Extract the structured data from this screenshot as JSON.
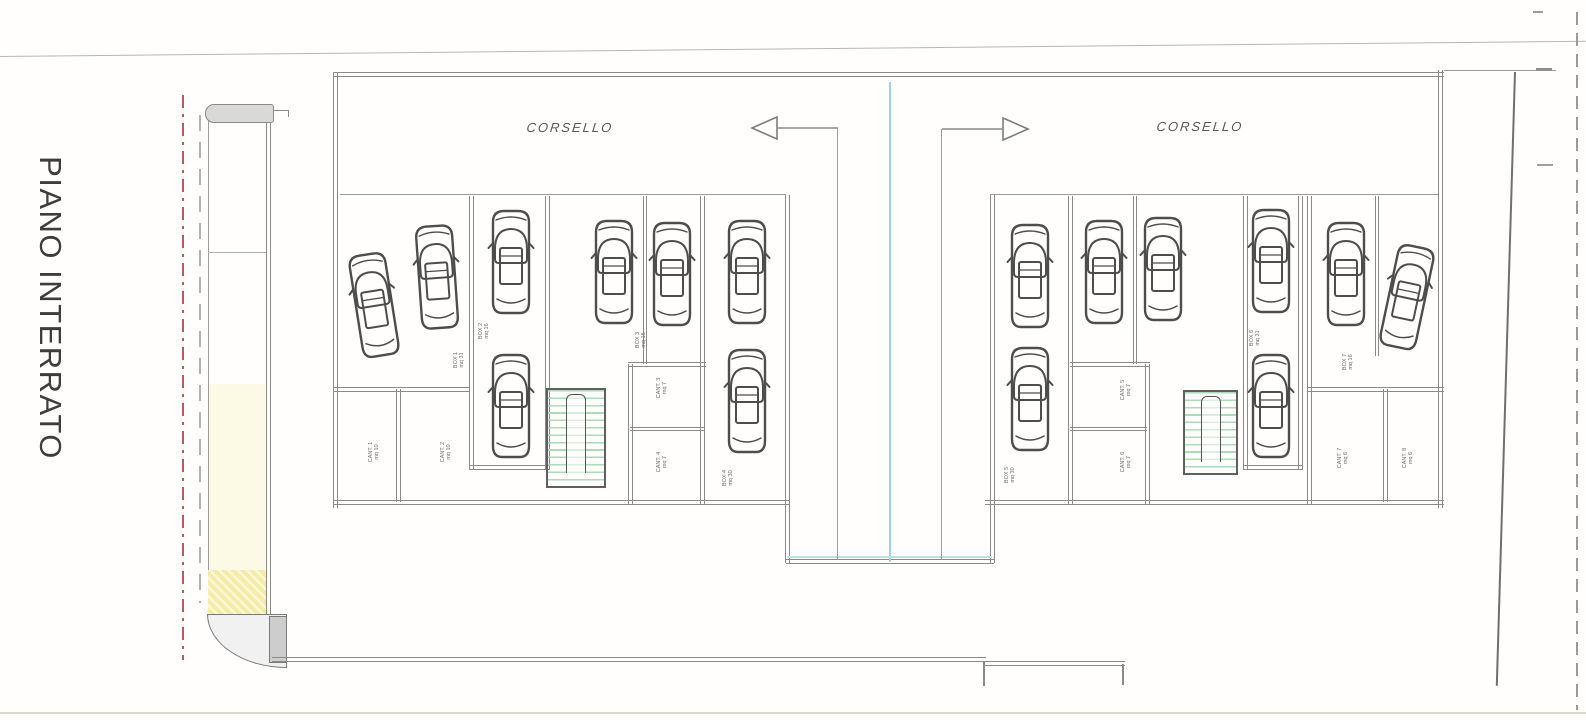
{
  "title": {
    "text": "PIANO INTERRATO"
  },
  "aisle_labels": {
    "left": "CORSELLO",
    "right": "CORSELLO"
  },
  "colors": {
    "wall_gray": "#8a8a8a",
    "thin_line": "#9b9b9b",
    "centerline_cyan": "#9ad6d8",
    "boundary_red": "#b85a5a",
    "stair_green": "#aedab6",
    "ramp_yellow": "#f4eba6",
    "text_dark": "#3d3d3d"
  },
  "plan": {
    "car_count": 16,
    "cars": [
      {
        "id": "car-1",
        "x": 374,
        "y": 305,
        "rot": -9
      },
      {
        "id": "car-2",
        "x": 437,
        "y": 277,
        "rot": -4
      },
      {
        "id": "car-3",
        "x": 511,
        "y": 262,
        "rot": 0
      },
      {
        "id": "car-4",
        "x": 511,
        "y": 406,
        "rot": 0
      },
      {
        "id": "car-5",
        "x": 614,
        "y": 272,
        "rot": 0
      },
      {
        "id": "car-6",
        "x": 672,
        "y": 274,
        "rot": 0
      },
      {
        "id": "car-7",
        "x": 747,
        "y": 272,
        "rot": 0
      },
      {
        "id": "car-8",
        "x": 747,
        "y": 401,
        "rot": 0
      },
      {
        "id": "car-9",
        "x": 1030,
        "y": 276,
        "rot": 0
      },
      {
        "id": "car-10",
        "x": 1030,
        "y": 399,
        "rot": 0
      },
      {
        "id": "car-11",
        "x": 1104,
        "y": 272,
        "rot": 0
      },
      {
        "id": "car-12",
        "x": 1163,
        "y": 269,
        "rot": 0
      },
      {
        "id": "car-13",
        "x": 1271,
        "y": 261,
        "rot": 0
      },
      {
        "id": "car-14",
        "x": 1271,
        "y": 406,
        "rot": 0
      },
      {
        "id": "car-15",
        "x": 1346,
        "y": 274,
        "rot": 0
      },
      {
        "id": "car-16",
        "x": 1407,
        "y": 297,
        "rot": 12
      }
    ],
    "room_labels": [
      {
        "x": 374,
        "y": 452,
        "text": "CANT. 1\nmq 10"
      },
      {
        "x": 446,
        "y": 452,
        "text": "CANT. 2\nmq 10"
      },
      {
        "x": 459,
        "y": 360,
        "text": "BOX 1\nmq 31"
      },
      {
        "x": 484,
        "y": 331,
        "text": "BOX 2\nmq 16"
      },
      {
        "x": 641,
        "y": 340,
        "text": "BOX 3\nmq 16"
      },
      {
        "x": 662,
        "y": 388,
        "text": "CANT. 3\nmq 7"
      },
      {
        "x": 662,
        "y": 462,
        "text": "CANT. 4\nmq 7"
      },
      {
        "x": 728,
        "y": 478,
        "text": "BOX 4\nmq 30"
      },
      {
        "x": 1010,
        "y": 475,
        "text": "BOX 5\nmq 30"
      },
      {
        "x": 1126,
        "y": 390,
        "text": "CANT. 5\nmq 7"
      },
      {
        "x": 1126,
        "y": 462,
        "text": "CANT. 6\nmq 7"
      },
      {
        "x": 1255,
        "y": 338,
        "text": "BOX 6\nmq 31"
      },
      {
        "x": 1348,
        "y": 362,
        "text": "BOX 7\nmq 16"
      },
      {
        "x": 1343,
        "y": 458,
        "text": "CANT. 7\nmq 6"
      },
      {
        "x": 1408,
        "y": 458,
        "text": "CANT. 8\nmq 6"
      }
    ],
    "stairs": [
      {
        "x": 546,
        "y": 388,
        "w": 60,
        "h": 100
      },
      {
        "x": 1183,
        "y": 390,
        "w": 55,
        "h": 85
      }
    ],
    "arrows": [
      {
        "dir": "left"
      },
      {
        "dir": "right"
      }
    ]
  }
}
